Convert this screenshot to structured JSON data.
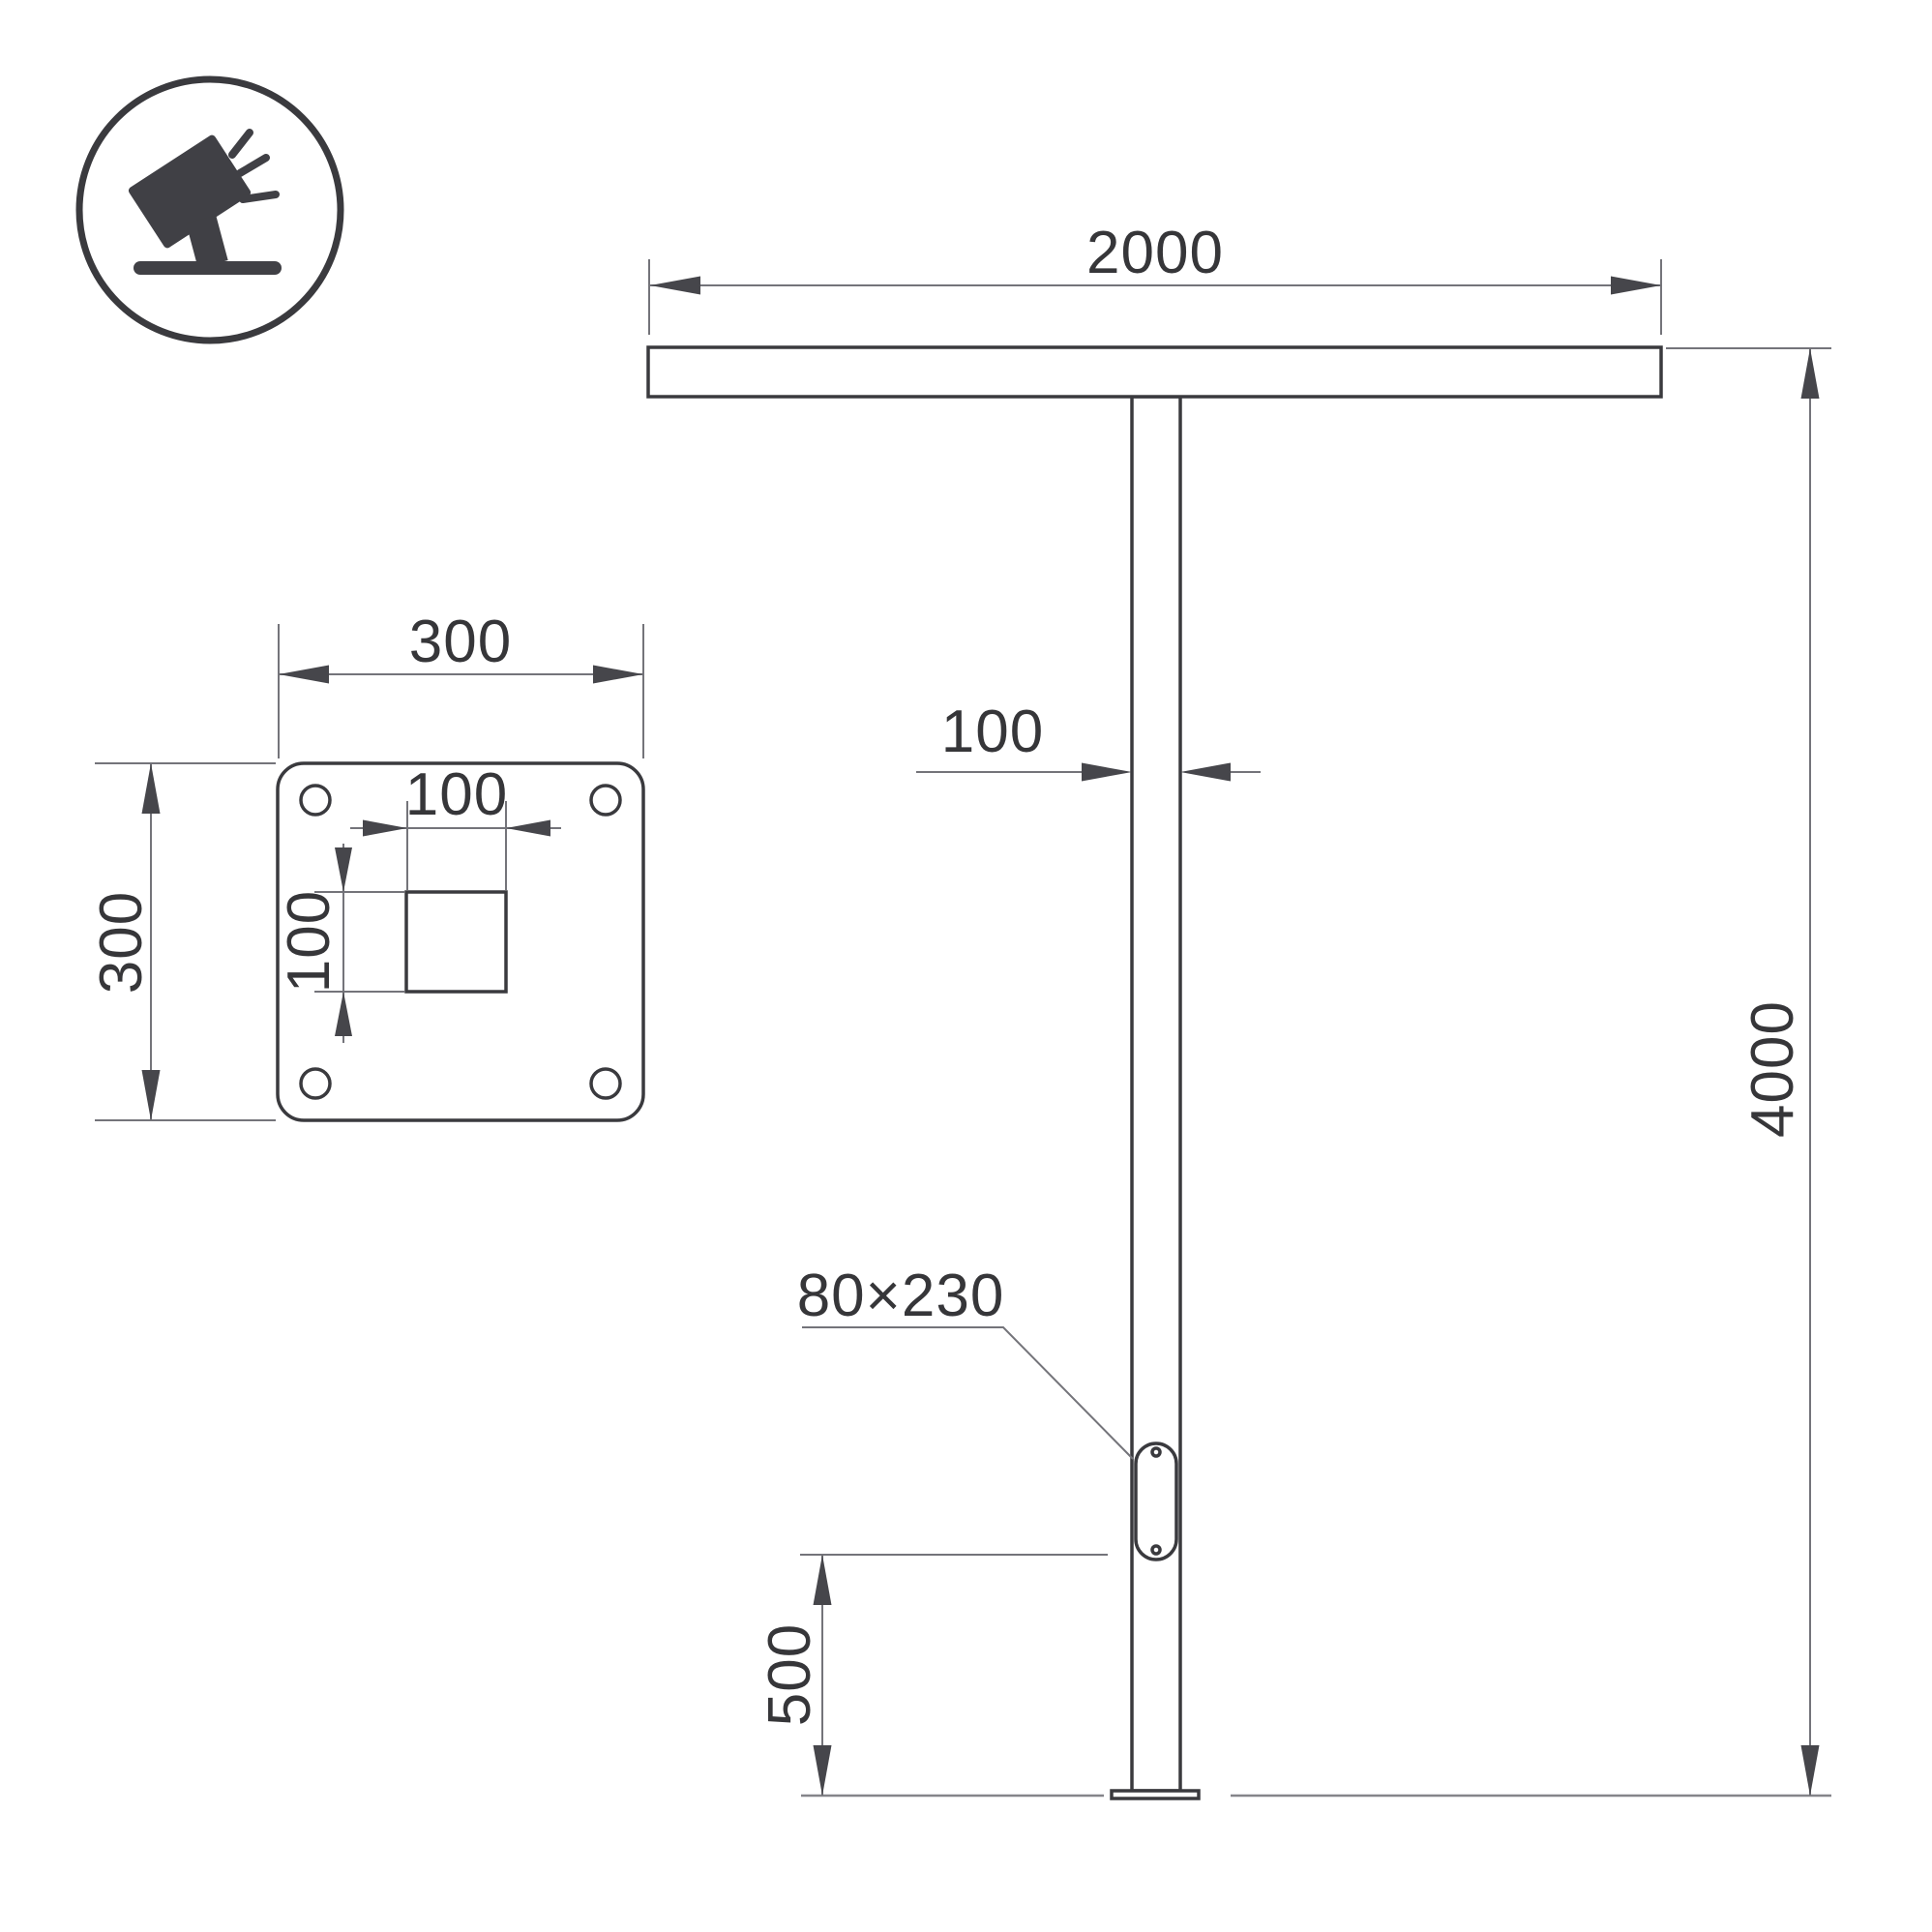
{
  "drawing": {
    "type": "technical-dimension-drawing",
    "subject": "T-shaped street light pole with mounting base plate",
    "background": "#ffffff",
    "colors": {
      "object_line": "#3a3a3e",
      "dimension_line": "#74747a",
      "text": "#363639",
      "icon": "#404045"
    },
    "icon": {
      "name": "tilted-floodlight-on-stand",
      "shape": "circle-outline"
    },
    "front_view": {
      "labels": {
        "arm_span": "2000",
        "pole_width": "100",
        "pole_height": "4000",
        "hatch_size": "80×230",
        "hatch_bottom_offset": "500"
      }
    },
    "base_plate_view": {
      "labels": {
        "plate_width": "300",
        "plate_height": "300",
        "hole_width": "100",
        "hole_height": "100"
      },
      "bolt_holes": 4,
      "center_hole": "square"
    }
  }
}
